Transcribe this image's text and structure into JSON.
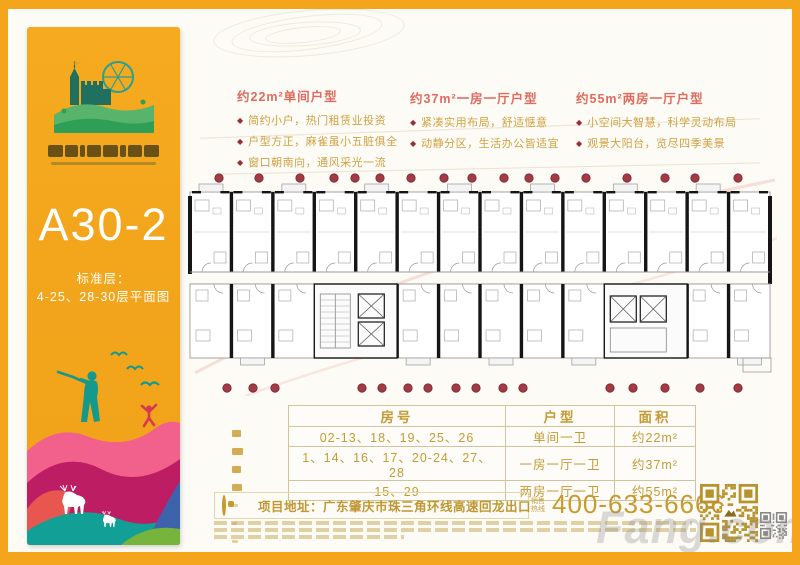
{
  "sidebar": {
    "plan_code": "A30-2",
    "floor_line1": "标准层：",
    "floor_line2": "4-25、28-30层平面图",
    "bg_color": "#f2a41c",
    "logo_icon": "castle-ferris-wheel-hill"
  },
  "sections": [
    {
      "title": "约22m²单间户型",
      "bullets": [
        "简约小户，热门租赁业投资",
        "户型方正，麻雀虽小五脏俱全",
        "窗口朝南向，通风采光一流"
      ]
    },
    {
      "title": "约37m²一房一厅户型",
      "bullets": [
        "紧凑实用布局，舒适惬意",
        "动静分区，生活办公皆适宜"
      ]
    },
    {
      "title": "约55m²两房一厅户型",
      "bullets": [
        "小空间大智慧，科学灵动布局",
        "观景大阳台，览尽四季美景"
      ]
    }
  ],
  "table": {
    "headers": [
      "房号",
      "户型",
      "面积"
    ],
    "rows": [
      [
        "02-13、18、19、25、26",
        "单间一卫",
        "约22m²"
      ],
      [
        "1、14、16、17、20-24、27、28",
        "一房一厅一卫",
        "约37m²"
      ],
      [
        "15、29",
        "两房一厅一卫",
        "约55m²"
      ]
    ]
  },
  "footer": {
    "address": "项目地址：广东肇庆市珠三角环线高速回龙出口",
    "hotline_label": "销售热线",
    "hotline_number": "400-633-6666",
    "watermark": "Fang.com"
  },
  "floor_plan": {
    "marker_color": "#a13b46",
    "marker_edge_color": "#7c2733",
    "top_marker_count": 17,
    "bottom_marker_count": 16,
    "wall_color": "#151515",
    "line_color": "#999999"
  },
  "colors": {
    "frame": "#f4a51c",
    "title_red": "#e06a5e",
    "bullet_gold": "#cfa144",
    "table_gold": "#c39b33",
    "phone_gold": "#c79a2e"
  }
}
